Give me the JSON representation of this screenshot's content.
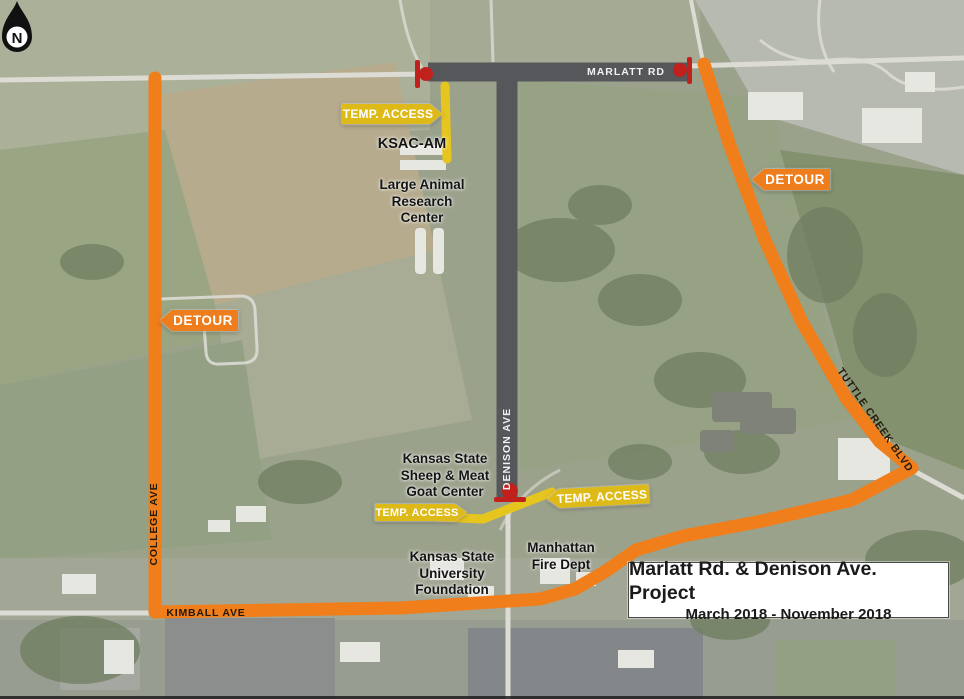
{
  "title_box": {
    "line1": "Marlatt Rd. & Denison Ave. Project",
    "line2": "March 2018 - November 2018"
  },
  "compass": {
    "label": "N"
  },
  "roads": {
    "marlatt": {
      "label": "MARLATT RD"
    },
    "denison": {
      "label": "DENISON AVE"
    },
    "college": {
      "label": "COLLEGE AVE"
    },
    "kimball": {
      "label": "KIMBALL AVE"
    },
    "tuttle_creek": {
      "label": "TUTTLE CREEK BLVD"
    }
  },
  "flags": {
    "detour_west": {
      "label": "DETOUR"
    },
    "detour_east": {
      "label": "DETOUR"
    },
    "temp_access_north": {
      "label": "TEMP. ACCESS"
    },
    "temp_access_south_west": {
      "label": "TEMP. ACCESS"
    },
    "temp_access_south_east": {
      "label": "TEMP. ACCESS"
    }
  },
  "places": {
    "ksac": {
      "line1": "KSAC-AM"
    },
    "large_animal": {
      "line1": "Large Animal",
      "line2": "Research",
      "line3": "Center"
    },
    "sheep_goat": {
      "line1": "Kansas State",
      "line2": "Sheep & Meat",
      "line3": "Goat Center"
    },
    "ksu_foundation": {
      "line1": "Kansas State",
      "line2": "University",
      "line3": "Foundation"
    },
    "fire_dept": {
      "line1": "Manhattan",
      "line2": "Fire Dept"
    }
  },
  "legend_colors": {
    "detour_route": "#F07E1A",
    "closed_road": "#55575B",
    "temp_access_road": "#E7C51F",
    "closure_marker": "#C1211C"
  }
}
